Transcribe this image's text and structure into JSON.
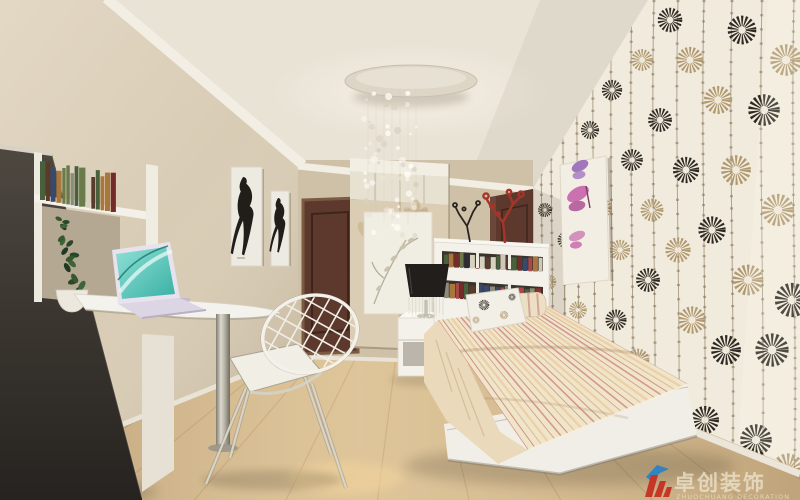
{
  "meta": {
    "type": "interior-render",
    "room": "teen bedroom with floral accent wall"
  },
  "watermark": {
    "brand_cn": "卓创装饰",
    "brand_en": "ZHUOCHUANG DECORATION"
  },
  "scene": {
    "objects": [
      "crystal chandelier on round ceiling plate",
      "floral wallpaper accent wall (black and tan daisies on cream)",
      "butterfly art panel",
      "single bed with white bookshelf headboard",
      "striped cream bedding",
      "floral cushion and striped bolster",
      "white nightstand with black crystal table lamp",
      "red and black coral branch ornaments",
      "wardrobe with floral sliding doors and leaf print panel",
      "dark brown interior doors",
      "two fashion-figure art prints",
      "white wall desk with laptop and notebook",
      "dark tall cabinet with book shelf and potted plant",
      "white wire mesh chair",
      "light wood laminate floor"
    ]
  },
  "palette": {
    "ceiling": "#e9e3d6",
    "left_wall": "#d9ccb5",
    "back_wall": "#cfc1a8",
    "cornice_white": "#f2eee4",
    "floor_wood": "#d9be92",
    "floor_line": "#b3945f",
    "wallpaper_cream": "#f1ebdd",
    "flower_black": "#2e2a23",
    "flower_tan": "#b0986f",
    "stem_brown": "#8d7c60",
    "white_furniture": "#f3f1ea",
    "dark_cabinet": "#3f3a33",
    "door_brown": "#5d392d",
    "bedding_cream": "#f1e5c9",
    "stripe_pink": "#cc8484",
    "lamp_black": "#211e1b",
    "coral_red": "#a53529",
    "butterfly_pink": "#c763a8",
    "butterfly_purple": "#9260b5",
    "laptop_teal": "#56c8bd",
    "plant_green": "#30502e",
    "watermark_text": "#ede4d0",
    "logo_red": "#c62a1c",
    "logo_blue": "#2582c8"
  }
}
